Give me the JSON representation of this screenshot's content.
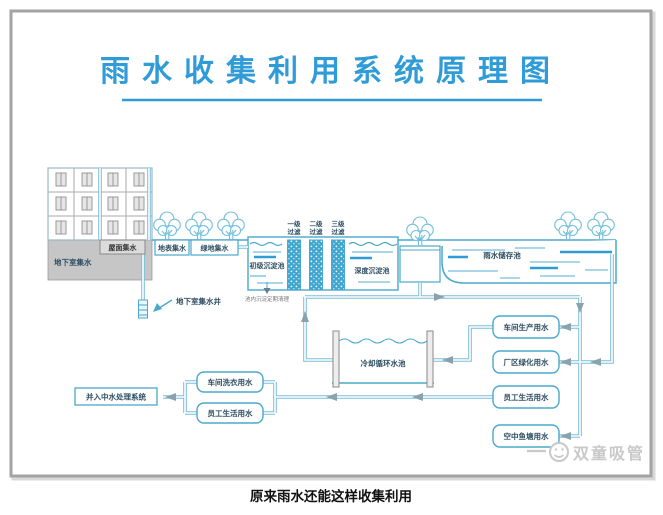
{
  "title": "雨水收集利用系统原理图",
  "caption": "原来雨水还能这样收集利用",
  "watermark": {
    "text": "双童吸管"
  },
  "building": {
    "basement": "地下室集水",
    "roof": "屋面集水"
  },
  "sources": {
    "surface": "地表集水",
    "green": "绿地集水",
    "well_label": "地下室集水井"
  },
  "tanks": {
    "primary": "初级沉淀池",
    "deep": "深度沉淀池",
    "note": "池内沉淀定期清理",
    "storage": "雨水储存池",
    "cooling": "冷却循环水池"
  },
  "filters": [
    {
      "line1": "一级",
      "line2": "过滤"
    },
    {
      "line1": "二级",
      "line2": "过滤"
    },
    {
      "line1": "三级",
      "line2": "过滤"
    }
  ],
  "usage": [
    "车间生产用水",
    "厂区绿化用水",
    "员工生活用水",
    "空中鱼塘用水"
  ],
  "cluster": {
    "system": "并入中水处理系统",
    "boxes": [
      "车间洗衣用水",
      "员工生活用水"
    ]
  },
  "colors": {
    "title_blue": "#2f9cd8",
    "line_blue": "#4aa8cc",
    "pipe_blue": "#7cbeda",
    "filter_fill": "#3fa6d0",
    "basement_gray": "#c6c6c6",
    "frame_gray": "#a3a3a3",
    "watermark_gray": "#c9c9c9",
    "caption_black": "#111111"
  }
}
